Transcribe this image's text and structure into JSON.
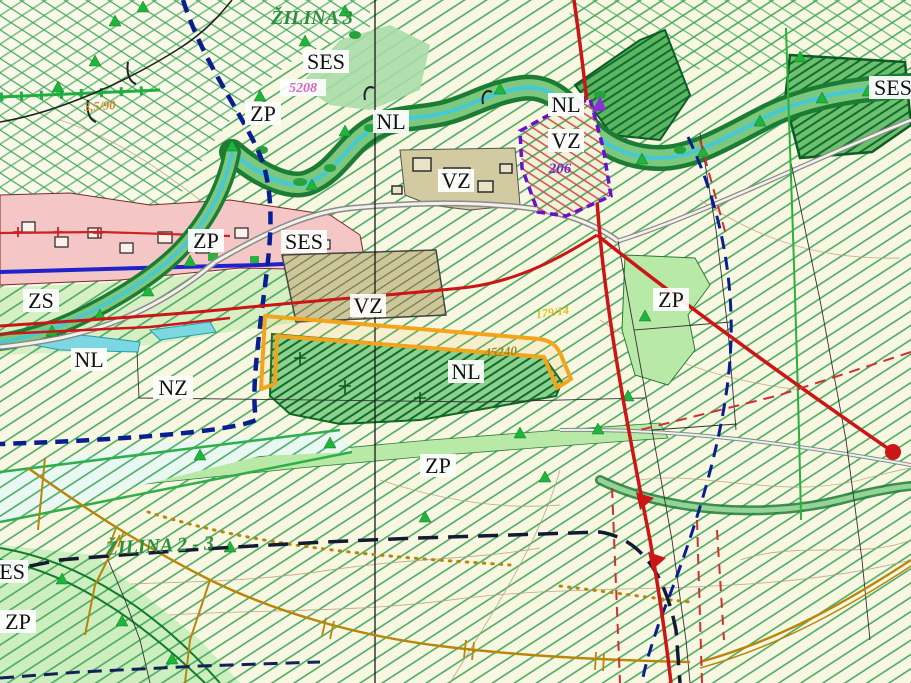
{
  "district_labels": [
    {
      "text": "ŽILINA 3"
    },
    {
      "text": "ŽILINA 2 - 3"
    }
  ],
  "zone_labels": [
    {
      "text": "SES"
    },
    {
      "text": "ZP"
    },
    {
      "text": "NL"
    },
    {
      "text": "NL"
    },
    {
      "text": "VZ"
    },
    {
      "text": "VZ"
    },
    {
      "text": "SES"
    },
    {
      "text": "ZP"
    },
    {
      "text": "SES"
    },
    {
      "text": "VZ"
    },
    {
      "text": "ZP"
    },
    {
      "text": "ZS"
    },
    {
      "text": "NL"
    },
    {
      "text": "NZ"
    },
    {
      "text": "NL"
    },
    {
      "text": "ZP"
    },
    {
      "text": "SES"
    },
    {
      "text": "ZP"
    }
  ],
  "parcel_labels": [
    {
      "text": "5208"
    },
    {
      "text": "206"
    },
    {
      "text": "45240"
    },
    {
      "text": "179/14"
    },
    {
      "text": "3,5/90"
    }
  ],
  "colors": {
    "base": "#f8f7e2",
    "hatch_green": "#3fa65a",
    "corridor_dark": "#1d7c33",
    "corridor_light": "#7cc87f",
    "stream_cyan": "#45c8d8",
    "zone_pink": "#f4c6c6",
    "zone_tan": "#cdc69d",
    "zone_light_green": "#b9e9a6",
    "parcel_meadow": "#8ed08e",
    "highlight_orange": "#f2a51c",
    "boundary_navy": "#0a1f8f",
    "cadastre_black": "#141a33",
    "line_red": "#cc1515",
    "zone_purple": "#6912cc",
    "utility_ochre": "#b8860b",
    "road_gray": "#8a8a8a",
    "contour_brown": "#bb9c7c",
    "water_cyan": "#7cd8e0"
  }
}
